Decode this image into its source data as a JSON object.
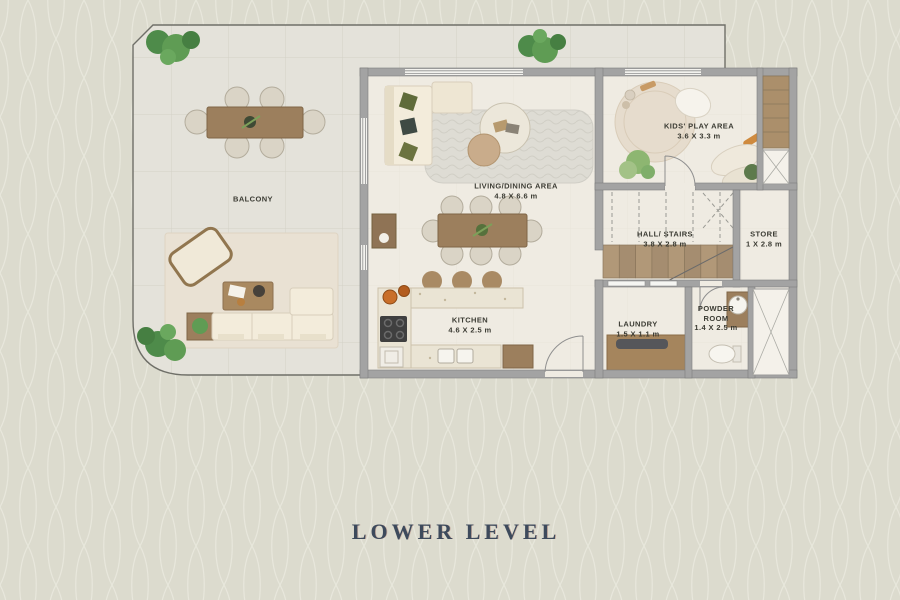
{
  "title": {
    "text": "LOWER LEVEL"
  },
  "rooms": {
    "balcony": {
      "name": "BALCONY"
    },
    "living_dining": {
      "name": "LIVING/DINING AREA",
      "dims": "4.8 X 6.6 m"
    },
    "kids_play": {
      "name": "KIDS' PLAY AREA",
      "dims": "3.6 X 3.3 m"
    },
    "hall_stairs": {
      "name": "HALL/ STAIRS",
      "dims": "3.8 X 2.8 m"
    },
    "store": {
      "name": "STORE",
      "dims": "1 X 2.8 m"
    },
    "kitchen": {
      "name": "KITCHEN",
      "dims": "4.6 X 2.5 m"
    },
    "laundry": {
      "name": "LAUNDRY",
      "dims": "1.5 X 1.1 m"
    },
    "powder_room": {
      "name": "POWDER ROOM",
      "dims": "1.4 X 2.5 m"
    }
  },
  "colors": {
    "background": "#dcdbce",
    "pattern_line": "#e8e7dc",
    "wall": "#a3a3a3",
    "interior_floor": "#efebe2",
    "balcony_floor": "#e4e2da",
    "wood": "#9c7f5d",
    "plant_green": "#4e8b4a",
    "sofa_cream": "#f3ecdb",
    "title_text": "#3d4a5c",
    "label_text": "#3b3b33"
  }
}
